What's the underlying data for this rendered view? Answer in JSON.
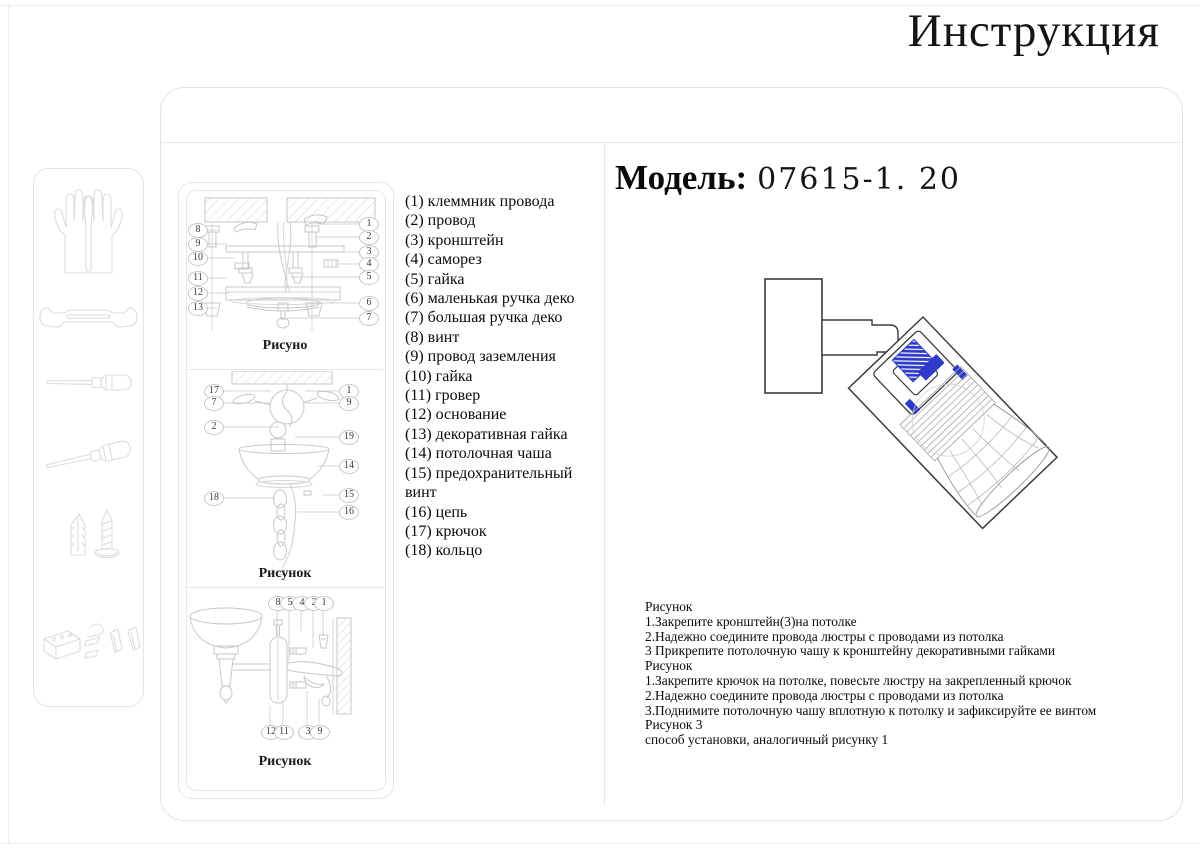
{
  "title": "Инструкция",
  "model": {
    "label": "Модель:",
    "number": "07615-1. 20"
  },
  "parts": {
    "lines": [
      "(1) клеммник провода",
      "(2) провод",
      "(3) кронштейн",
      "(4) саморез",
      "(5) гайка",
      "(6) маленькая ручка деко",
      "(7) большая ручка деко",
      "(8) винт",
      "(9) провод заземления",
      "(10) гайка",
      "(11) гровер",
      "(12) основание",
      "(13) декоративная гайка",
      "(14) потолочная чаша",
      "(15) предохранительный",
      "винт",
      "(16) цепь",
      "(17) крючок",
      "(18) кольцо"
    ]
  },
  "figures": {
    "fig1": {
      "label": "Рисуно",
      "left": [
        "8",
        "9",
        "10",
        "11",
        "12",
        "13"
      ],
      "right": [
        "1",
        "2",
        "3",
        "4",
        "5",
        "6",
        "7"
      ]
    },
    "fig2": {
      "label": "Рисунок",
      "left": [
        "17",
        "7",
        "2",
        "18"
      ],
      "right": [
        "1",
        "9",
        "19",
        "14",
        "15",
        "16"
      ]
    },
    "fig3": {
      "label": "Рисунок",
      "top": [
        "8",
        "5",
        "4",
        "2",
        "1"
      ],
      "bottom": [
        "12",
        "11",
        "3",
        "9"
      ]
    }
  },
  "instructions": {
    "lines": [
      "Рисунок",
      "1.Закрепите кронштейн(3)на потолке",
      "2.Надежно соедините провода люстры с проводами из потолка",
      "3 Прикрепите потолочную чашу к кронштейну декоративными гайками",
      "Рисунок",
      "1.Закрепите крючок на потолке, повесьте люстру на закрепленный крючок",
      "2.Надежно соедините провода люстры с проводами из потолка",
      "3.Поднимите потолочную чашу вплотную к потолку и зафиксируйте ее винтом",
      "Рисунок 3",
      "способ установки,  аналогичный рисунку 1"
    ]
  },
  "colors": {
    "accent_blue": "#2d3bc8"
  }
}
